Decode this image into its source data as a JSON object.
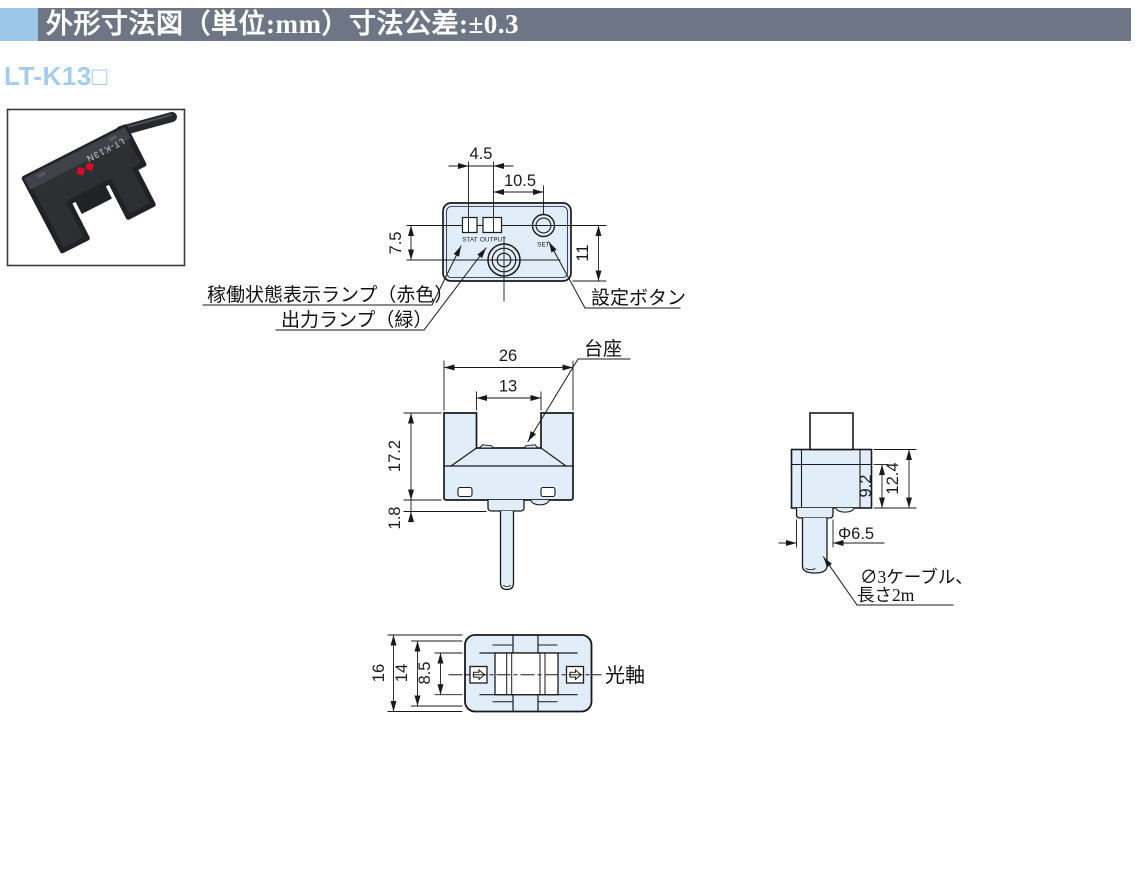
{
  "header": {
    "title": "外形寸法図（単位:mm）寸法公差:±0.3",
    "bar_color": "#6e7686",
    "accent_color": "#9cc7e8"
  },
  "model_heading": "LT-K13□",
  "photo": {
    "model_label": "LT-K13N",
    "logo_color": "#ce1126"
  },
  "diagram": {
    "fill_color": "#e1eefa",
    "line_color": "#1a1a1a",
    "top_view": {
      "dim_4_5": "4.5",
      "dim_10_5": "10.5",
      "dim_7_5": "7.5",
      "dim_11": "11",
      "led_stat": "STAT",
      "led_output": "OUTPUT",
      "set_label": "SET",
      "label_status_lamp": "稼働状態表示ランプ（赤色）",
      "label_output_lamp": "出力ランプ（緑）",
      "label_set_button": "設定ボタン"
    },
    "front_view": {
      "dim_width": "26",
      "dim_slot": "13",
      "dim_height": "17.2",
      "dim_boss": "1.8",
      "label_pedestal": "台座"
    },
    "side_view": {
      "dim_9_2": "9.2",
      "dim_12_4": "12.4",
      "dim_diameter": "Φ6.5",
      "label_cable_line1": "∅3ケーブル、",
      "label_cable_line2": "長さ2m"
    },
    "bottom_view": {
      "dim_16": "16",
      "dim_14": "14",
      "dim_8_5": "8.5",
      "label_optical_axis": "光軸"
    }
  }
}
